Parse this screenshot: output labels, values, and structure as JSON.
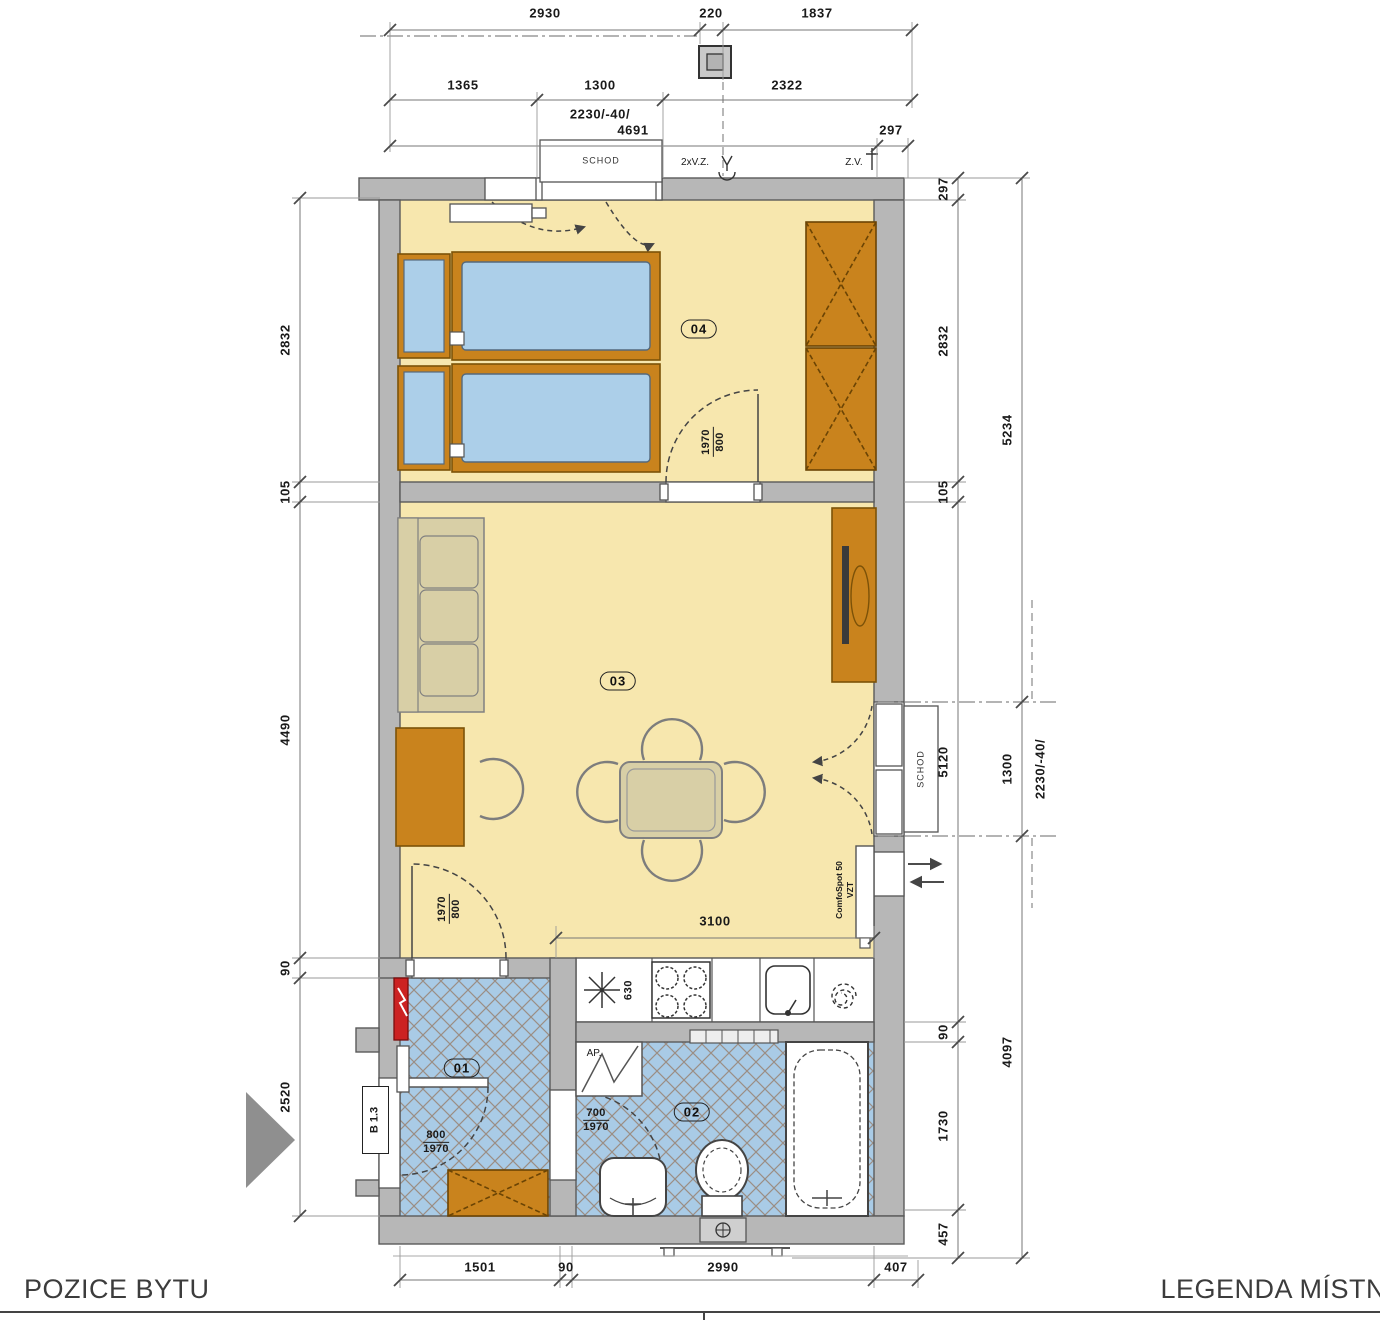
{
  "footer": {
    "left": "POZICE BYTU",
    "right": "LEGENDA MÍSTN"
  },
  "rooms": {
    "r01": "01",
    "r02": "02",
    "r03": "03",
    "r04": "04"
  },
  "dims": {
    "top": {
      "d2930": "2930",
      "d220": "220",
      "d1837": "1837",
      "d1365": "1365",
      "d1300": "1300",
      "d2322": "2322",
      "d2230": "2230/-40/",
      "d4691": "4691",
      "d297": "297"
    },
    "left": {
      "d2832": "2832",
      "d105": "105",
      "d4490": "4490",
      "d90": "90",
      "d2520": "2520"
    },
    "right": {
      "d297": "297",
      "d2832": "2832",
      "d105": "105",
      "d5120": "5120",
      "d90": "90",
      "d1730": "1730",
      "d457": "457",
      "d5234": "5234",
      "d1300": "1300",
      "d2230": "2230/-40/",
      "d4097": "4097"
    },
    "bottom": {
      "d1501": "1501",
      "d90": "90",
      "d2990": "2990",
      "d407": "407"
    },
    "kitchen": "3100"
  },
  "doors": {
    "bedroom": {
      "w": "1970",
      "h": "800"
    },
    "hall_living": {
      "w": "1970",
      "h": "800"
    },
    "entry": {
      "w": "800",
      "h": "1970"
    },
    "bath": {
      "w": "700",
      "h": "1970"
    }
  },
  "labels": {
    "unit": "B 1.3",
    "comfospot_line1": "ComfoSpot 50",
    "comfospot_line2": "VZT",
    "washer": "AP.",
    "fan": "630",
    "step_top": "SCHOD",
    "step_right": "SCHOD",
    "note_vz": "2xV.Z.",
    "note_zv": "Z.V."
  },
  "colors": {
    "floor": "#f7e7ae",
    "tile": "#a9cbe6",
    "wall": "#b7b7b7",
    "furniture": "#c9831d",
    "accent_red": "#cc2222"
  }
}
